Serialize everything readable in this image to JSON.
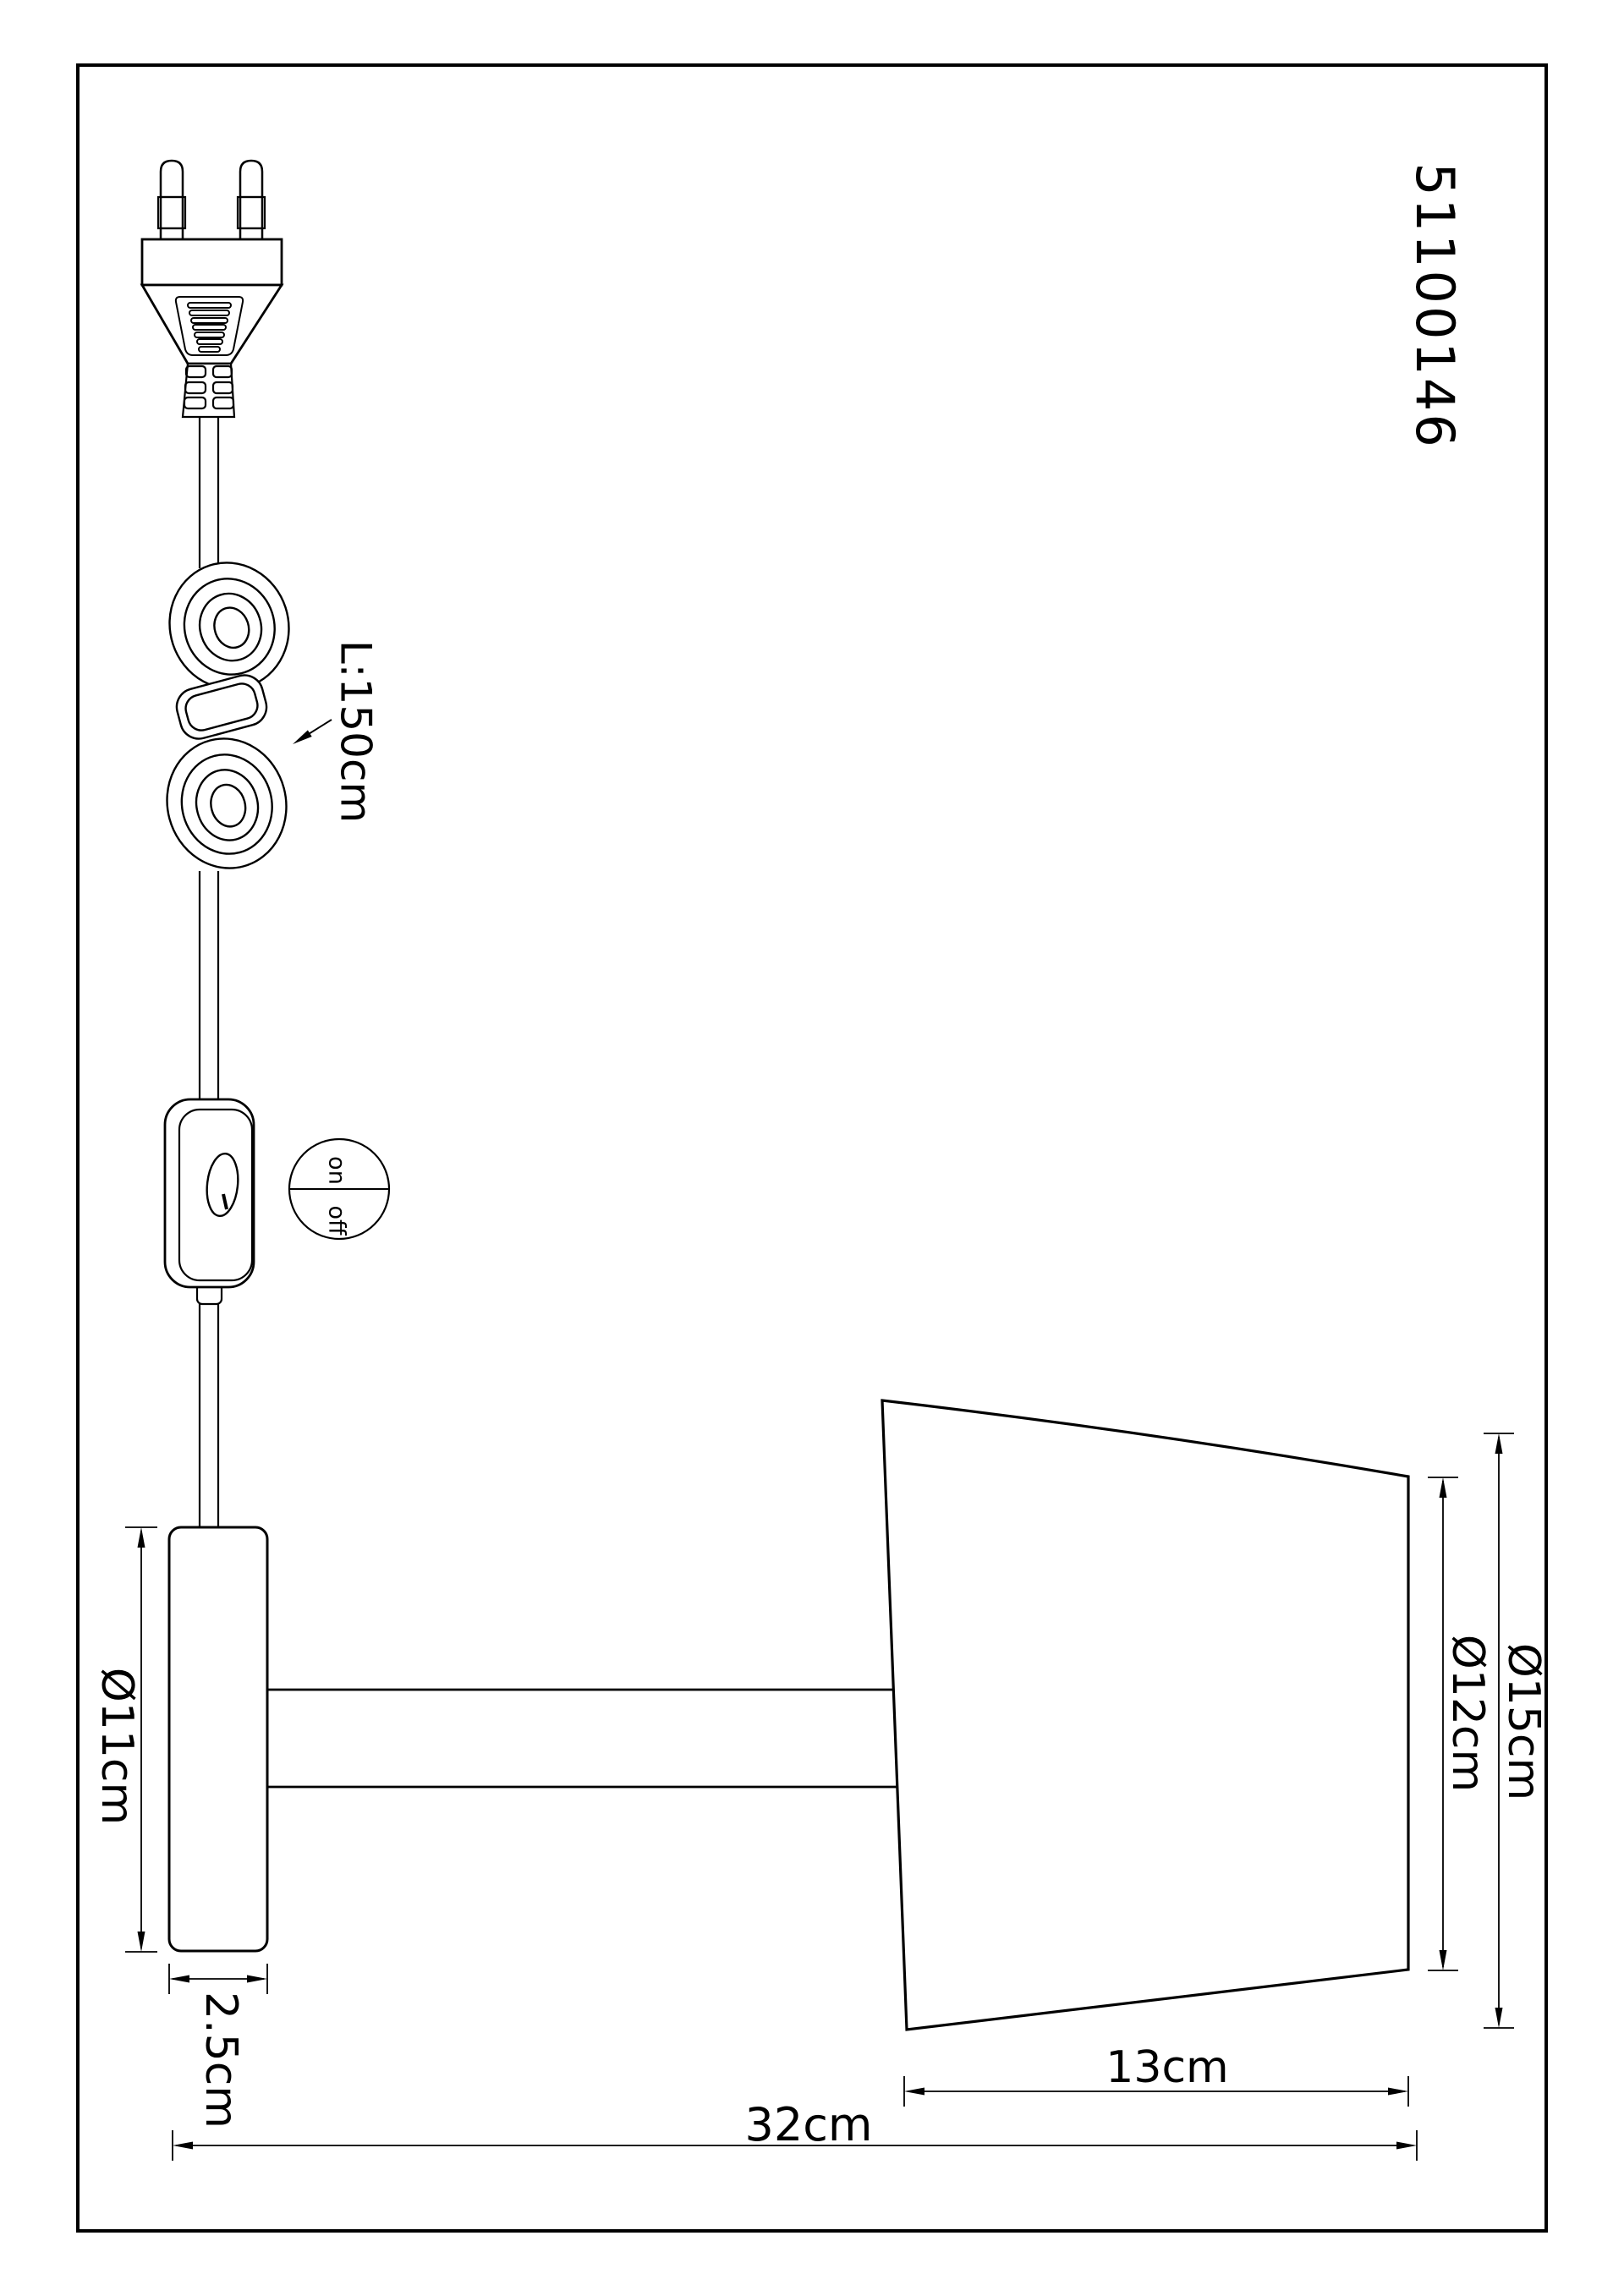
{
  "page": {
    "background": "#ffffff",
    "line_color": "#000000"
  },
  "drawing": {
    "part_number": "51100146",
    "cable": {
      "length_label": "L:150cm"
    },
    "switch_indicator": {
      "on": "on",
      "off": "off"
    },
    "dimensions": {
      "mount_plate_diameter": "Ø11cm",
      "mount_plate_depth": "2.5cm",
      "shade_front_diameter": "Ø12cm",
      "shade_max_diameter": "Ø15cm",
      "shade_depth": "13cm",
      "total_projection": "32cm"
    }
  }
}
